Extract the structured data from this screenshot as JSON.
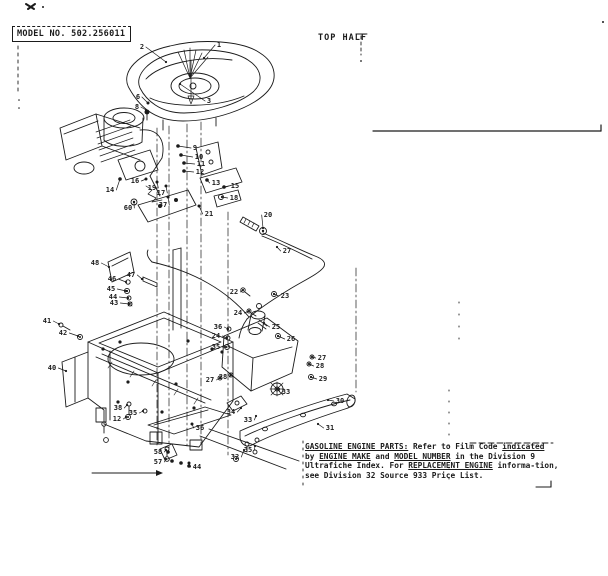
{
  "header": {
    "model_label": "MODEL NO. 502.256011",
    "section_label": "TOP HALF"
  },
  "footer": {
    "lines": [
      [
        {
          "t": "GASOLINE ENGINE PARTS:",
          "u": true
        },
        {
          "t": "  Refer to Film Code ",
          "u": false
        },
        {
          "t": "indicated",
          "u": true
        }
      ],
      [
        {
          "t": "by ",
          "u": false
        },
        {
          "t": "ENGINE MAKE",
          "u": true
        },
        {
          "t": " and ",
          "u": false
        },
        {
          "t": "MODEL NUMBER",
          "u": true
        },
        {
          "t": " in the Division 9",
          "u": false
        }
      ],
      [
        {
          "t": "Ultrafiche Index.  For ",
          "u": false
        },
        {
          "t": "REPLACEMENT ENGINE",
          "u": true
        },
        {
          "t": " informa-tion,",
          "u": false
        }
      ],
      [
        {
          "t": "see Division 32 Source 933 Price List.",
          "u": false
        }
      ]
    ]
  },
  "diagram": {
    "description": "Exploded view of gasoline engine top half assembly",
    "callouts": [
      [
        "1",
        219,
        45,
        204,
        58
      ],
      [
        "2",
        142,
        47,
        166,
        62
      ],
      [
        "3",
        209,
        101,
        180,
        84
      ],
      [
        "6",
        138,
        97,
        148,
        103
      ],
      [
        "8",
        137,
        107,
        146,
        110
      ],
      [
        "9",
        195,
        148,
        178,
        146
      ],
      [
        "10",
        199,
        157,
        181,
        155
      ],
      [
        "11",
        201,
        164,
        184,
        163
      ],
      [
        "12",
        200,
        172,
        184,
        171
      ],
      [
        "13",
        216,
        183,
        207,
        180
      ],
      [
        "15",
        235,
        186,
        224,
        187
      ],
      [
        "18",
        234,
        198,
        222,
        197
      ],
      [
        "16",
        135,
        181,
        146,
        179
      ],
      [
        "19",
        152,
        188,
        157,
        182
      ],
      [
        "17",
        161,
        193,
        166,
        186
      ],
      [
        "37",
        163,
        205,
        168,
        197
      ],
      [
        "14",
        110,
        190,
        120,
        179
      ],
      [
        "60",
        128,
        208,
        134,
        202
      ],
      [
        "21",
        209,
        214,
        199,
        206
      ],
      [
        "20",
        268,
        215,
        263,
        228
      ],
      [
        "27",
        287,
        251,
        277,
        247
      ],
      [
        "22",
        234,
        292,
        243,
        290
      ],
      [
        "23",
        285,
        296,
        274,
        294
      ],
      [
        "24",
        238,
        313,
        249,
        311
      ],
      [
        "25",
        276,
        327,
        264,
        323
      ],
      [
        "26",
        291,
        339,
        278,
        336
      ],
      [
        "36",
        218,
        327,
        228,
        329
      ],
      [
        "24",
        216,
        336,
        227,
        338
      ],
      [
        "35",
        216,
        347,
        226,
        347
      ],
      [
        "27",
        210,
        380,
        220,
        378
      ],
      [
        "28",
        223,
        377,
        231,
        375
      ],
      [
        "27",
        322,
        358,
        312,
        357
      ],
      [
        "28",
        320,
        366,
        309,
        364
      ],
      [
        "29",
        323,
        379,
        311,
        377
      ],
      [
        "33",
        286,
        392,
        279,
        389
      ],
      [
        "30",
        340,
        401,
        328,
        400
      ],
      [
        "31",
        330,
        428,
        318,
        424
      ],
      [
        "34",
        231,
        412,
        241,
        408
      ],
      [
        "33",
        248,
        420,
        256,
        416
      ],
      [
        "32",
        235,
        457,
        244,
        450
      ],
      [
        "35",
        248,
        450,
        255,
        446
      ],
      [
        "41",
        47,
        321,
        59,
        324
      ],
      [
        "42",
        63,
        333,
        78,
        336
      ],
      [
        "40",
        52,
        368,
        66,
        371
      ],
      [
        "48",
        95,
        263,
        109,
        267
      ],
      [
        "46",
        112,
        279,
        126,
        282
      ],
      [
        "47",
        131,
        275,
        142,
        279
      ],
      [
        "45",
        111,
        289,
        126,
        291
      ],
      [
        "44",
        113,
        297,
        128,
        298
      ],
      [
        "43",
        114,
        303,
        129,
        304
      ],
      [
        "38",
        118,
        408,
        127,
        405
      ],
      [
        "12",
        117,
        419,
        126,
        417
      ],
      [
        "35",
        133,
        413,
        143,
        411
      ],
      [
        "36",
        200,
        428,
        192,
        424
      ],
      [
        "58",
        158,
        452,
        166,
        450
      ],
      [
        "57",
        158,
        462,
        166,
        459
      ],
      [
        "44",
        197,
        467,
        189,
        463
      ]
    ]
  },
  "colors": {
    "ink": "#1b1b1b",
    "paper": "#ffffff"
  }
}
